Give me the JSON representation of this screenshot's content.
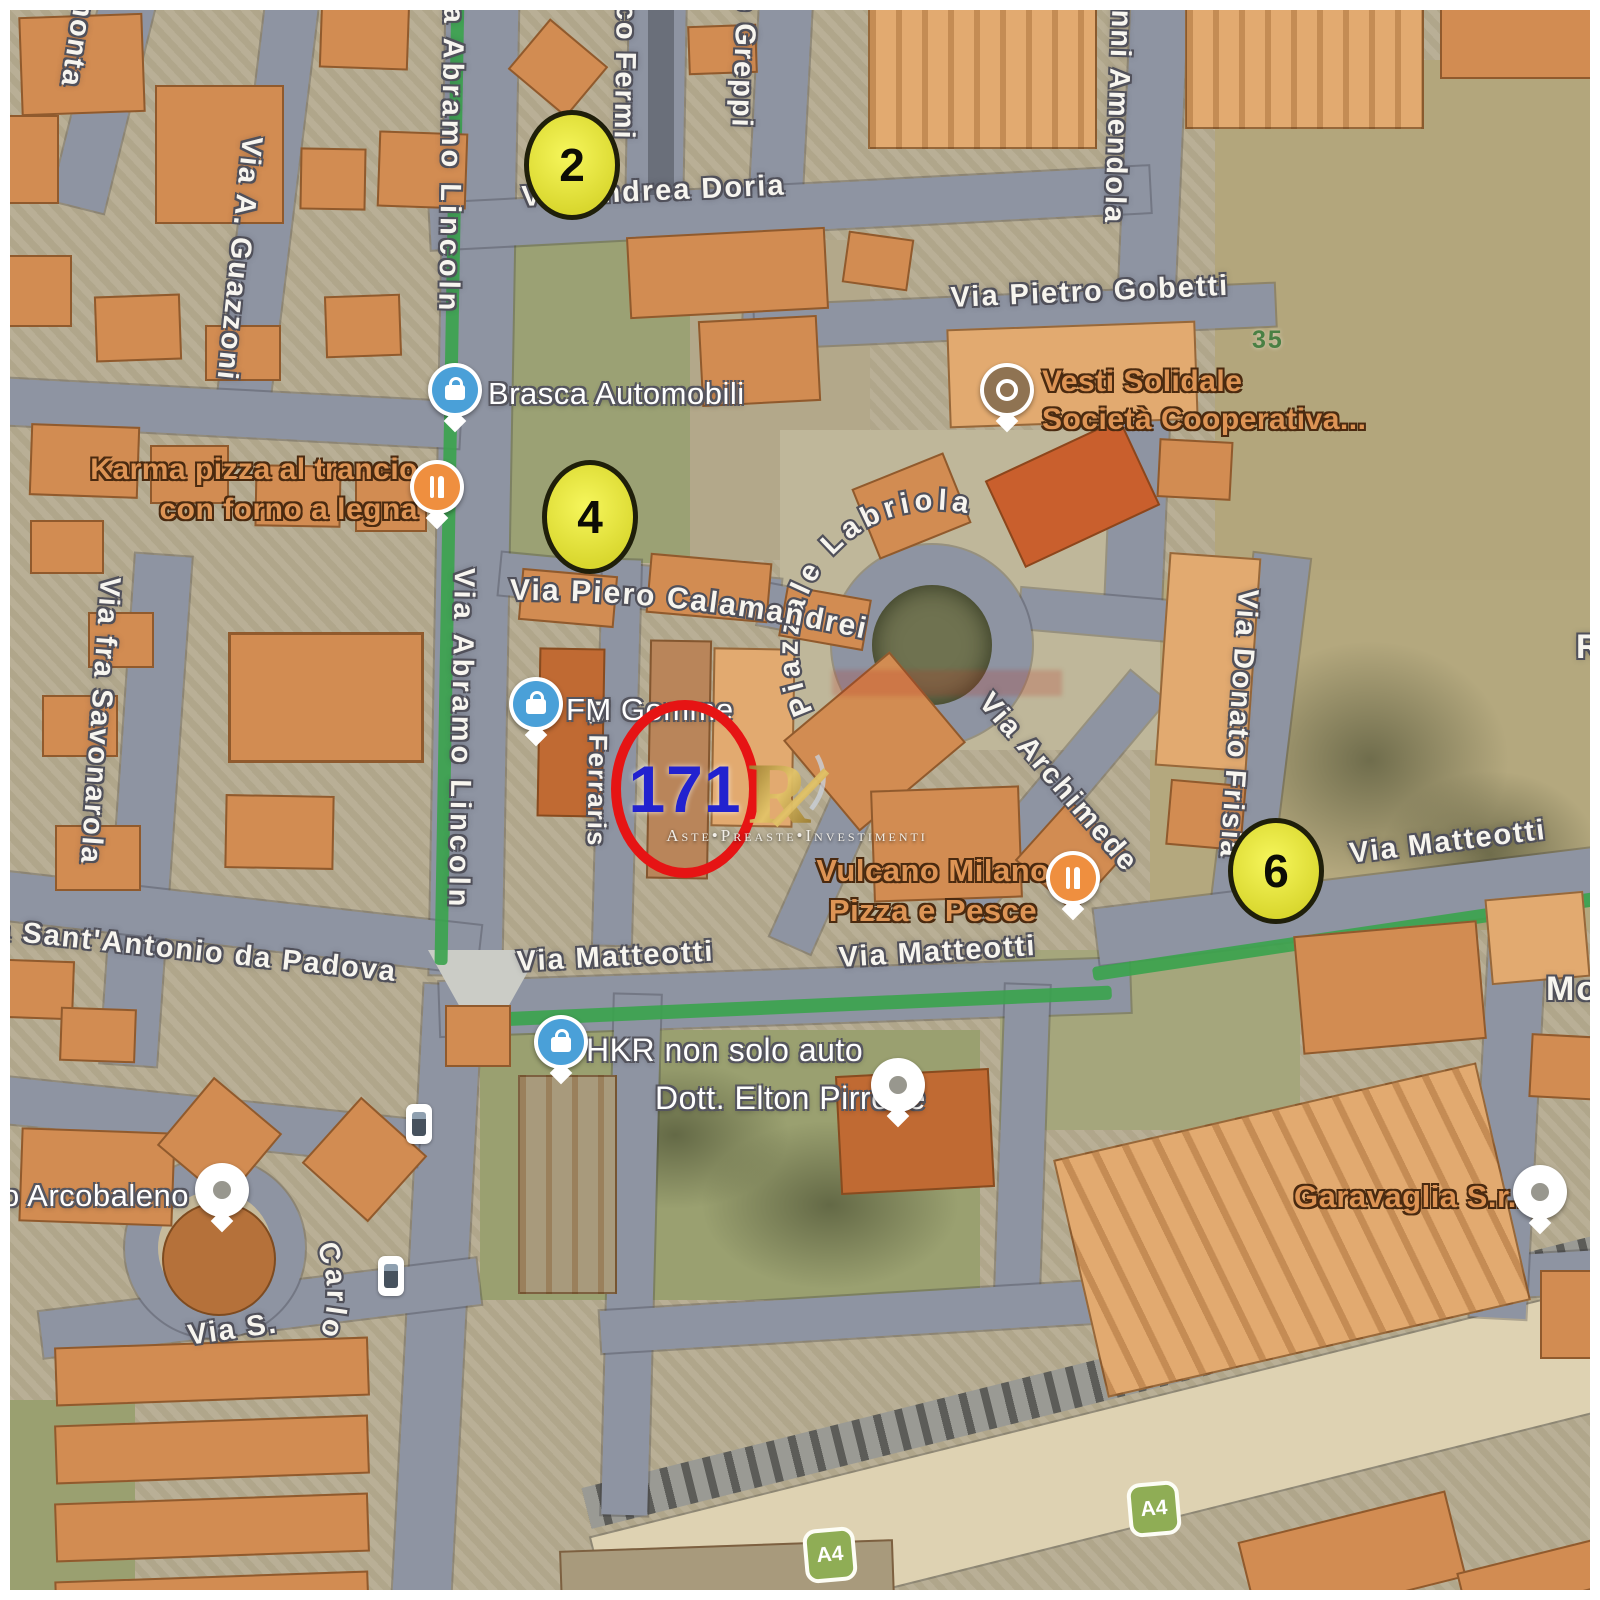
{
  "map": {
    "streets": {
      "monta": "monta",
      "guazzoni": "Via A. Guazzoni",
      "lincoln_top": "Via Abramo Lincoln",
      "lincoln_mid": "Via Abramo Lincoln",
      "fermi": "co Fermi",
      "greppi": "o Greppi",
      "amendola": "anni Amendola",
      "andrea_doria": "Via Andrea Doria",
      "pietro_gobetti": "Via Pietro Gobetti",
      "piero_calamandrei": "Via Piero Calamandrei",
      "piazzale_labriola": "Piazzale Labriola",
      "archimede": "Via Archimede",
      "donato_frisia": "Via Donato Frisia",
      "ferraris": "ia Ferraris",
      "matteotti_left": "Via Matteotti",
      "matteotti_center": "Via Matteotti",
      "matteotti_right": "Via Matteotti",
      "sant_antonio": "a Sant'Antonio da Padova",
      "fra_savonarola": "Via fra Savonarola",
      "via_s": "Via S.",
      "carlo": "Carlo",
      "edge_r": "R",
      "edge_mos": "Mos",
      "number_35": "35"
    },
    "pois": {
      "brasca": {
        "label": "Brasca Automobili"
      },
      "karma": {
        "line1": "Karma pizza al trancio",
        "line2": "con forno a legna"
      },
      "vesti": {
        "line1": "Vesti Solidale",
        "line2": "Società Cooperativa..."
      },
      "fm_gomme": {
        "label": "FM Gomme"
      },
      "vulcano": {
        "line1": "Vulcano Milano",
        "line2": "Pizza e Pesce"
      },
      "hkr": {
        "label": "HKR non solo auto"
      },
      "pirrone": {
        "label": "Dott. Elton Pirrone"
      },
      "arcobaleno": {
        "label": "o Arcobaleno"
      },
      "garavaglia": {
        "label": "Garavaglia S.r.l"
      }
    },
    "markers": {
      "n2": "2",
      "n4": "4",
      "n6": "6",
      "subject": "171"
    },
    "shields": {
      "a4_left": "A4",
      "a4_right": "A4"
    },
    "watermark": {
      "monogram": "R",
      "caption": "Aste•Preaste•Investimenti"
    },
    "colors": {
      "route_green": "#3aa34d",
      "road_gray": "#8e94a2",
      "building_orange": "#d28c52",
      "terrain_tan": "#b5ab90",
      "grass_olive": "#9aa070",
      "marker_yellow": "#e9e73b",
      "marker_outline": "#1f1f0a",
      "subject_ring_red": "#e61414",
      "subject_number_blue": "#2222cf",
      "shield_green": "#8fad55",
      "watermark_gold": "#c9a94f",
      "highway_cream": "#ded2b2"
    }
  }
}
